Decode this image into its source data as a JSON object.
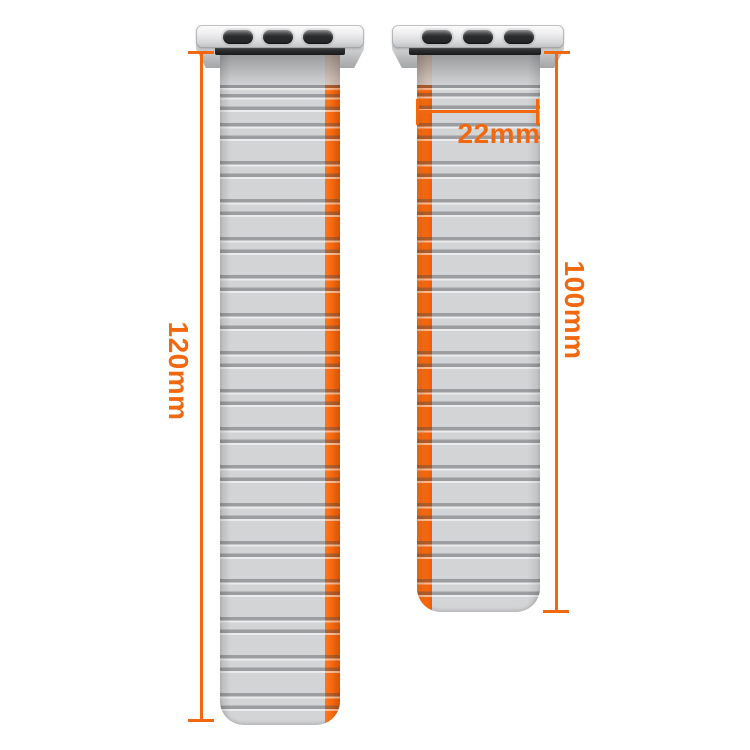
{
  "title": "Silicone watch band size diagram",
  "colors": {
    "accent_orange": "#f2680f",
    "stripe_orange": "#fb6a10",
    "strap_gray": "#d3d4d6"
  },
  "bands": {
    "left": {
      "name": "long band segment",
      "length_label": "120mm"
    },
    "right": {
      "name": "short band segment",
      "length_label": "100mm",
      "width_label": "22mm"
    }
  }
}
